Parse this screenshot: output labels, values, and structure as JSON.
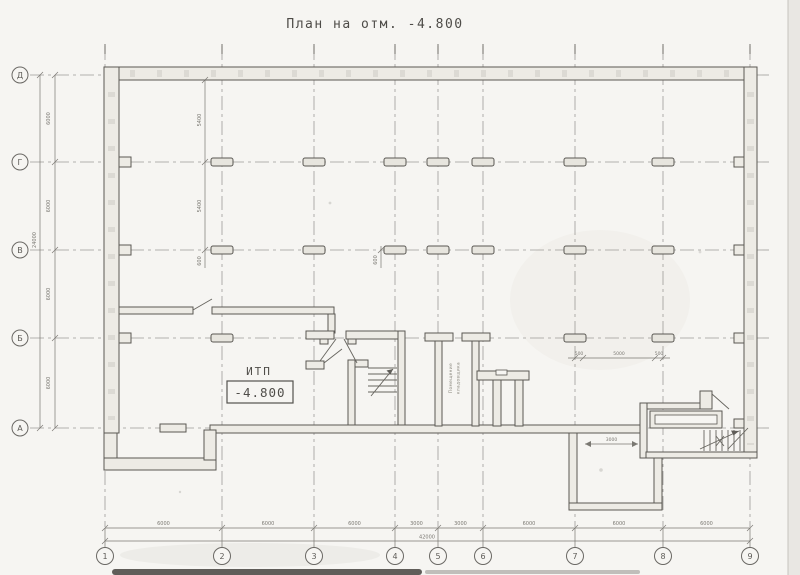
{
  "title": "План на отм. -4.800",
  "plan": {
    "itp_label": "ИТП",
    "itp_elevation": "-4.800",
    "room_line1": "Помещение",
    "room_line2": "кладовщика"
  },
  "axes": {
    "rows": [
      "Д",
      "Г",
      "В",
      "Б",
      "А"
    ],
    "cols": [
      "1",
      "2",
      "3",
      "4",
      "5",
      "6",
      "7",
      "8",
      "9"
    ]
  },
  "dims": {
    "left_chain": [
      "6000",
      "6000",
      "6000",
      "6000"
    ],
    "left_total": "24000",
    "bottom_chain": [
      "6000",
      "6000",
      "6000",
      "3000",
      "3000",
      "6000",
      "6000",
      "6000"
    ],
    "bottom_total": "42000",
    "inner": {
      "col2_upper": "5400",
      "col2_lower": "5400",
      "col2_small": "600",
      "col4_small": "600",
      "b_left": "500",
      "b_mid": "5000",
      "b_right": "500",
      "pit_width": "3000"
    }
  },
  "colors": {
    "paper": "#f6f5f2",
    "line": "#5a5853",
    "grid": "#9d9b97",
    "wall_fill": "#edebe5"
  }
}
